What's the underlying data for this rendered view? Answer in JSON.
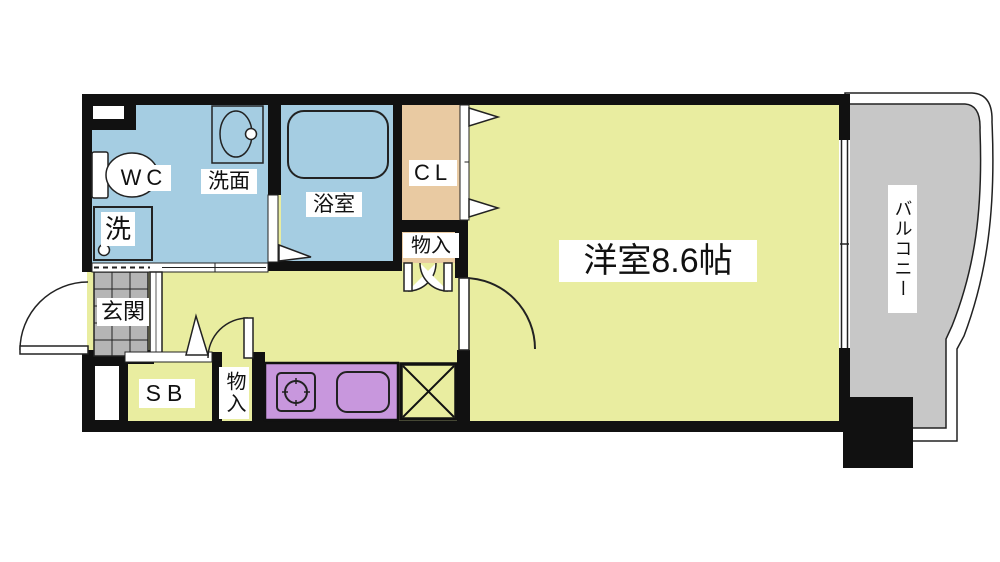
{
  "plan": {
    "labels": {
      "wc": "WC",
      "laundry": "洗",
      "washroom": "洗面",
      "bathroom": "浴室",
      "closet": "CL",
      "storage_upper": "物入",
      "main_room": "洋室8.6帖",
      "entrance": "玄関",
      "shoe_box": "SB",
      "storage_lower": "物入",
      "balcony": "バルコニー"
    },
    "colors": {
      "wall": "#111111",
      "wet_area": "#a5cde2",
      "living_area": "#e9eda0",
      "closet_area": "#e9caa2",
      "kitchen_counter": "#c897dd",
      "balcony_floor": "#c7c7c7",
      "entrance_tile": "#b5b5b5",
      "line": "#222222",
      "label_bg": "#ffffff"
    }
  }
}
